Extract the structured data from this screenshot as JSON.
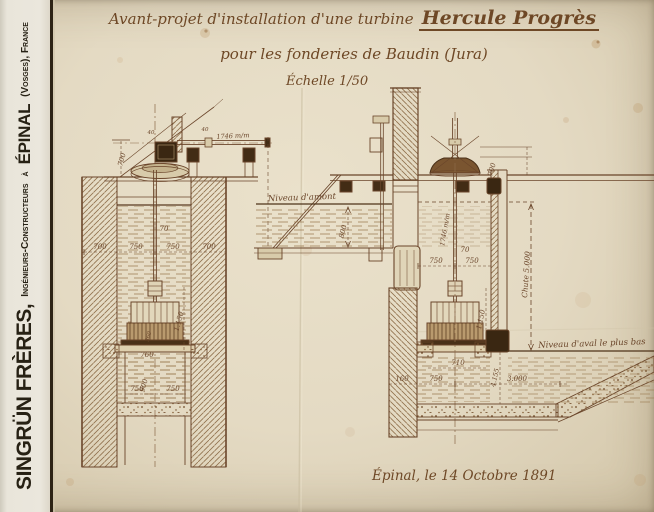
{
  "sidebar": {
    "name": "SINGRÜN FRÈRES,",
    "role": "Ingénieurs-Constructeurs",
    "connector": "à",
    "city": "ÉPINAL",
    "suffix": "(Vosges), France"
  },
  "title": {
    "prefix": "Avant-projet d'installation d'une turbine",
    "turbine": "Hercule Progrès",
    "line2": "pour les fonderies de Baudin (Jura)",
    "scale": "Échelle 1/50"
  },
  "footer": {
    "date": "Épinal, le 14 Octobre 1891"
  },
  "labels": {
    "amont": "Niveau d'amont",
    "aval": "Niveau d'aval le plus bas",
    "chute": "Chute 5.000",
    "l_shaft": "1746 m/m",
    "r_shaft": "1746 m/m",
    "l_g700": "700",
    "l_40a": "40",
    "l_40b": "40",
    "l_700a": "700",
    "l_750a": "750",
    "l_750b": "750",
    "l_700b": "700",
    "l_70": "70",
    "l_1150": "1.150",
    "l_360": "360",
    "l_760": "760",
    "l_900": "900",
    "l_750c": "750",
    "l_750d": "750",
    "r_800": "800",
    "r_g700": "700",
    "r_70": "70",
    "r_750a": "750",
    "r_750b": "750",
    "r_1150": "1.150",
    "r_710": "710",
    "r_4155": "4.155",
    "r_160": "160",
    "r_750c": "750",
    "r_3000": "3.000"
  },
  "colors": {
    "ink": "#6a452a",
    "dark_ink": "#3a2712",
    "paper": "#e4dac3",
    "strip": "#ebe7dd"
  }
}
